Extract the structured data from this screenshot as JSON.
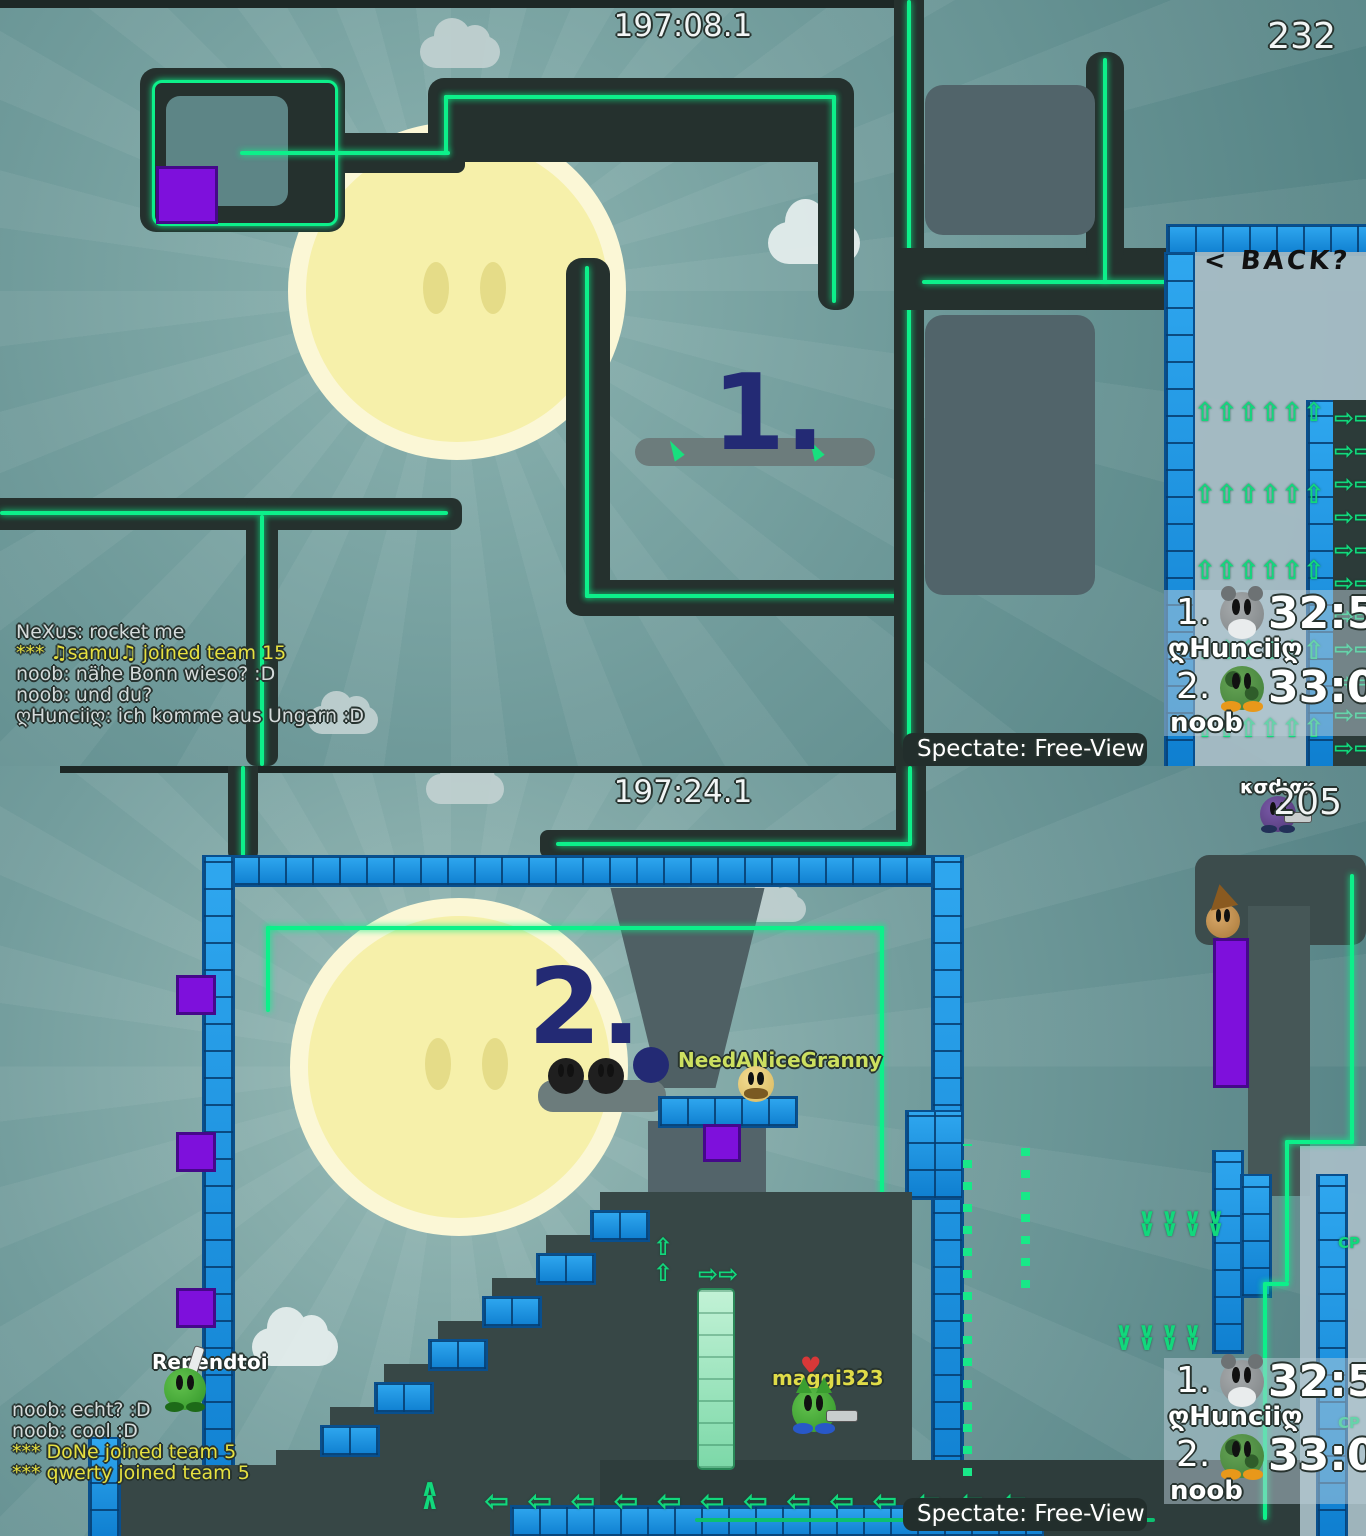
{
  "colors": {
    "laser_green": "#0df08a",
    "block_blue": "#1a8fe0",
    "block_purple": "#7e10dc",
    "step_navy": "#232a74",
    "chat_system_yellow": "#e6e040",
    "name_yellow_green": "#cde060",
    "sun_yellow": "#f6f1ab"
  },
  "hud": {
    "spectate_label": "Spectate: Free-View"
  },
  "icons": {
    "up_arrows_row": "⇧⇧⇧⇧⇧⇧",
    "right_arrows_column": "⇨⇨\n⇨⇨\n⇨⇨\n⇨⇨\n⇨⇨\n⇨⇨\n⇨⇨\n⇨⇨\n⇨⇨\n⇨⇨\n⇨⇨",
    "left_arrows_row": "⇦⇦⇦⇦⇦⇦⇦⇦⇦⇦⇦⇦⇦",
    "up_arrows_stack": "⇧\n⇧",
    "right_arrows_pair": "⇨⇨",
    "down_chevrons_row": "∨∨∨∨\n∨∨∨∨",
    "up_chevron_stack": "∧\n∧",
    "heart": "♥"
  },
  "leaderboard": {
    "rows": [
      {
        "rank": "1.",
        "time": "32:58",
        "name": "ღHunciiღ"
      },
      {
        "rank": "2.",
        "time": "33:01",
        "name": "noob"
      }
    ]
  },
  "shot1": {
    "timer": "197:08.1",
    "score": "232",
    "step_label": "1.",
    "back_label": "< BACK?",
    "chat": [
      {
        "text": "NeXus: rocket me"
      },
      {
        "text": "*** ♫samu♫ joined team 15"
      },
      {
        "text": "noob: nähe Bonn wieso? :D"
      },
      {
        "text": "noob: und du?"
      },
      {
        "text": "ღHunciiღ: ich komme aus Ungarn :D"
      }
    ]
  },
  "shot2": {
    "timer": "197:24.1",
    "score": "205",
    "step_label": "2.",
    "cp_label": "CP",
    "players": {
      "kodiak": "κσdιακ",
      "granny": "NeedANiceGranny",
      "rependtoi": "Rependtoi",
      "maggi": "maggi323"
    },
    "chat": [
      {
        "text": "noob: echt? :D"
      },
      {
        "text": "noob: cool :D"
      },
      {
        "text": "*** DoNe joined team 5"
      },
      {
        "text": "*** qwerty joined team 5"
      }
    ]
  }
}
